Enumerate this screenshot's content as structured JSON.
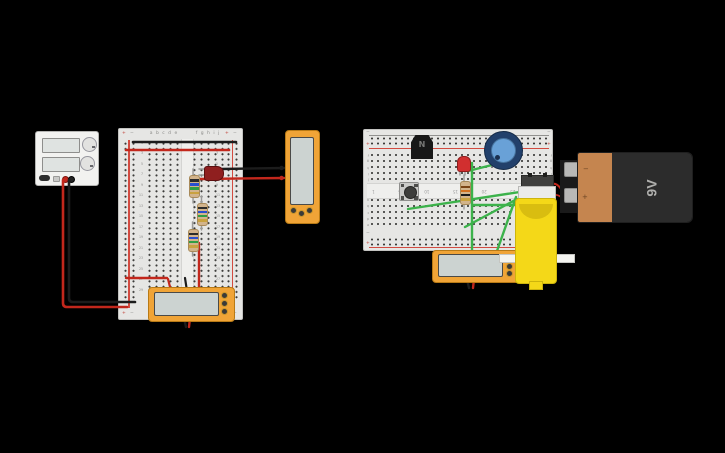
{
  "canvas": {
    "width": 725,
    "height": 453,
    "background": "#000000"
  },
  "battery": {
    "label": "9V",
    "terminal_minus": "−",
    "terminal_plus": "+"
  },
  "transistor": {
    "label": "N"
  },
  "breadboard_left": {
    "plus": "+",
    "minus": "−",
    "columns_left": "a b c d e",
    "columns_right": "f g h i j",
    "row_numbers": [
      "1",
      "3",
      "5",
      "7",
      "9",
      "11",
      "13",
      "15",
      "17",
      "19",
      "21",
      "23",
      "25",
      "27",
      "29"
    ]
  },
  "breadboard_right": {
    "plus": "+",
    "minus": "−",
    "letters_front": [
      "j",
      "i",
      "h",
      "g",
      "f"
    ],
    "letters_back": [
      "e",
      "d",
      "c",
      "b",
      "a"
    ],
    "channel_numbers": [
      "30",
      "25",
      "20",
      "15",
      "10",
      "5",
      "1"
    ]
  },
  "colors": {
    "board": "#e6e6e4",
    "rail_red": "#d24b40",
    "wire_red": "#c2271c",
    "wire_black": "#1c1c1c",
    "wire_green": "#3cb24b",
    "meter_orange": "#f0a437",
    "meter_screen": "#ccd3d1",
    "motor_yellow": "#f4d818",
    "battery_copper": "#c5854f",
    "battery_dark": "#2c2c2c",
    "pot_base_blue": "#22406b",
    "pot_knob_blue": "#69a1d7",
    "led_red": "#d12f2f",
    "resistor_tan": "#d2b48c"
  }
}
